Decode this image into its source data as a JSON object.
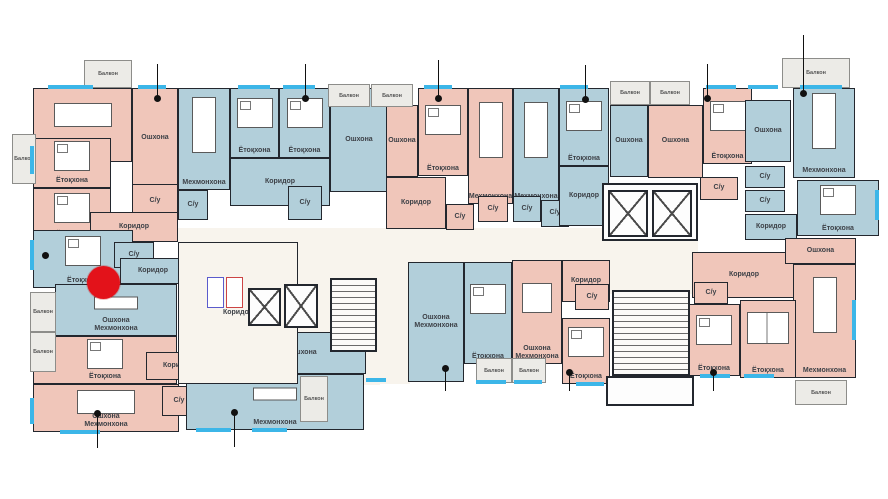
{
  "plan": {
    "canvas": {
      "w": 888,
      "h": 499
    },
    "colors": {
      "pink": "#f0c6ba",
      "blue": "#b2cfda",
      "wall": "#23272e",
      "cream": "#f8f4ed",
      "balcony": "#ecebe7",
      "window": "#3cb6e8",
      "red": "#e3121a",
      "dot": "#111111"
    },
    "backdrops": [
      {
        "x": 178,
        "y": 228,
        "w": 428,
        "h": 34
      },
      {
        "x": 378,
        "y": 258,
        "w": 32,
        "h": 126
      },
      {
        "x": 598,
        "y": 238,
        "w": 100,
        "h": 56
      },
      {
        "x": 296,
        "y": 256,
        "w": 84,
        "h": 128
      },
      {
        "x": 318,
        "y": 255,
        "w": 62,
        "h": 130
      }
    ]
  },
  "rooms": [
    {
      "name": "living-nw",
      "label": "Мехмонхона",
      "x": 33,
      "y": 88,
      "w": 99,
      "h": 74,
      "fill": "pink",
      "furniture": "table-h"
    },
    {
      "name": "kitchen-nw",
      "label": "Ошхона",
      "x": 132,
      "y": 88,
      "w": 46,
      "h": 100,
      "fill": "pink",
      "furniture": null
    },
    {
      "name": "bedroom-nw-1",
      "label": "Ётоқхона",
      "x": 33,
      "y": 138,
      "w": 78,
      "h": 50,
      "fill": "pink",
      "furniture": "bed"
    },
    {
      "name": "bedroom-nw-2",
      "label": "Ётоқхона",
      "x": 33,
      "y": 188,
      "w": 78,
      "h": 54,
      "fill": "pink",
      "furniture": "bed"
    },
    {
      "name": "bath-nw",
      "label": "С/у",
      "x": 132,
      "y": 184,
      "w": 46,
      "h": 34,
      "fill": "pink",
      "furniture": null
    },
    {
      "name": "corridor-nw",
      "label": "Коридор",
      "x": 90,
      "y": 212,
      "w": 88,
      "h": 30,
      "fill": "pink",
      "furniture": null
    },
    {
      "name": "living-a",
      "label": "Мехмонхона",
      "x": 178,
      "y": 88,
      "w": 52,
      "h": 102,
      "fill": "blue",
      "furniture": "table-v"
    },
    {
      "name": "bath-a1",
      "label": "С/у",
      "x": 178,
      "y": 190,
      "w": 30,
      "h": 30,
      "fill": "blue",
      "furniture": null
    },
    {
      "name": "bedroom-a1",
      "label": "Ётоқхона",
      "x": 230,
      "y": 88,
      "w": 49,
      "h": 70,
      "fill": "blue",
      "furniture": "bed"
    },
    {
      "name": "bedroom-a2",
      "label": "Ётоқхона",
      "x": 279,
      "y": 88,
      "w": 51,
      "h": 70,
      "fill": "blue",
      "furniture": "bed"
    },
    {
      "name": "corridor-a",
      "label": "Коридор",
      "x": 230,
      "y": 158,
      "w": 100,
      "h": 48,
      "fill": "blue",
      "furniture": null
    },
    {
      "name": "kitchen-a",
      "label": "Ошхона",
      "x": 330,
      "y": 88,
      "w": 58,
      "h": 104,
      "fill": "blue",
      "furniture": null
    },
    {
      "name": "bath-a2",
      "label": "С/у",
      "x": 288,
      "y": 186,
      "w": 34,
      "h": 34,
      "fill": "blue",
      "furniture": null
    },
    {
      "name": "kitchen-b",
      "label": "Ошхона",
      "x": 386,
      "y": 105,
      "w": 32,
      "h": 72,
      "fill": "pink",
      "furniture": null
    },
    {
      "name": "bedroom-b",
      "label": "Ётоқхона",
      "x": 418,
      "y": 88,
      "w": 50,
      "h": 88,
      "fill": "pink",
      "furniture": "bed"
    },
    {
      "name": "living-b",
      "label": "Мехмонхона",
      "x": 468,
      "y": 88,
      "w": 45,
      "h": 116,
      "fill": "pink",
      "furniture": "table-v"
    },
    {
      "name": "corridor-b",
      "label": "Коридор",
      "x": 386,
      "y": 177,
      "w": 60,
      "h": 52,
      "fill": "pink",
      "furniture": null
    },
    {
      "name": "bath-b1",
      "label": "С/у",
      "x": 446,
      "y": 204,
      "w": 28,
      "h": 26,
      "fill": "pink",
      "furniture": null
    },
    {
      "name": "bath-b2",
      "label": "С/у",
      "x": 478,
      "y": 196,
      "w": 30,
      "h": 26,
      "fill": "pink",
      "furniture": null
    },
    {
      "name": "living-c",
      "label": "Мехмонхона",
      "x": 513,
      "y": 88,
      "w": 46,
      "h": 116,
      "fill": "blue",
      "furniture": "table-v"
    },
    {
      "name": "bedroom-c",
      "label": "Ётоқхона",
      "x": 559,
      "y": 88,
      "w": 50,
      "h": 78,
      "fill": "blue",
      "furniture": "bed"
    },
    {
      "name": "bath-c1",
      "label": "С/у",
      "x": 513,
      "y": 196,
      "w": 28,
      "h": 26,
      "fill": "blue",
      "furniture": null
    },
    {
      "name": "bath-c2",
      "label": "С/у",
      "x": 541,
      "y": 200,
      "w": 28,
      "h": 27,
      "fill": "blue",
      "furniture": null
    },
    {
      "name": "corridor-c",
      "label": "Коридор",
      "x": 559,
      "y": 166,
      "w": 50,
      "h": 60,
      "fill": "blue",
      "furniture": null
    },
    {
      "name": "kitchen-d",
      "label": "Ошхона",
      "x": 610,
      "y": 105,
      "w": 38,
      "h": 72,
      "fill": "blue",
      "furniture": null
    },
    {
      "name": "kitchen-e",
      "label": "Ошхона",
      "x": 648,
      "y": 105,
      "w": 55,
      "h": 73,
      "fill": "pink",
      "furniture": null
    },
    {
      "name": "bedroom-e",
      "label": "Ётоқхона",
      "x": 703,
      "y": 88,
      "w": 49,
      "h": 76,
      "fill": "pink",
      "furniture": "bed"
    },
    {
      "name": "bath-e",
      "label": "С/у",
      "x": 700,
      "y": 177,
      "w": 38,
      "h": 23,
      "fill": "pink",
      "furniture": null
    },
    {
      "name": "kitchen-f",
      "label": "Ошхона",
      "x": 745,
      "y": 100,
      "w": 46,
      "h": 62,
      "fill": "blue",
      "furniture": null
    },
    {
      "name": "living-f",
      "label": "Мехмонхона",
      "x": 793,
      "y": 88,
      "w": 62,
      "h": 90,
      "fill": "blue",
      "furniture": "table-v"
    },
    {
      "name": "bath-f1",
      "label": "С/у",
      "x": 745,
      "y": 166,
      "w": 40,
      "h": 22,
      "fill": "blue",
      "furniture": null
    },
    {
      "name": "bath-f2",
      "label": "С/у",
      "x": 745,
      "y": 190,
      "w": 40,
      "h": 22,
      "fill": "blue",
      "furniture": null
    },
    {
      "name": "corridor-f",
      "label": "Коридор",
      "x": 745,
      "y": 214,
      "w": 52,
      "h": 26,
      "fill": "blue",
      "furniture": null
    },
    {
      "name": "bedroom-f",
      "label": "Ётоқхона",
      "x": 797,
      "y": 180,
      "w": 82,
      "h": 56,
      "fill": "blue",
      "furniture": "bed"
    },
    {
      "name": "bedroom-w1",
      "label": "Ётоқхона",
      "x": 33,
      "y": 230,
      "w": 100,
      "h": 58,
      "fill": "blue",
      "furniture": "bed"
    },
    {
      "name": "bath-w1",
      "label": "С/у",
      "x": 114,
      "y": 242,
      "w": 40,
      "h": 26,
      "fill": "blue",
      "furniture": null
    },
    {
      "name": "corridor-w1",
      "label": "Коридор",
      "x": 120,
      "y": 258,
      "w": 66,
      "h": 26,
      "fill": "blue",
      "furniture": null
    },
    {
      "name": "kitchen-living-w",
      "label": "Ошхона\nМехмонхона",
      "x": 55,
      "y": 284,
      "w": 122,
      "h": 52,
      "fill": "blue",
      "furniture": "sofa"
    },
    {
      "name": "bedroom-sw",
      "label": "Ётоқхона",
      "x": 33,
      "y": 336,
      "w": 144,
      "h": 48,
      "fill": "pink",
      "furniture": "bed"
    },
    {
      "name": "corridor-sw",
      "label": "Коридор",
      "x": 146,
      "y": 352,
      "w": 64,
      "h": 28,
      "fill": "pink",
      "furniture": null
    },
    {
      "name": "kitchen-living-sw",
      "label": "Ошхона\nМехмонхона",
      "x": 33,
      "y": 384,
      "w": 146,
      "h": 48,
      "fill": "pink",
      "furniture": "table-h"
    },
    {
      "name": "bath-sw",
      "label": "С/у",
      "x": 162,
      "y": 386,
      "w": 34,
      "h": 30,
      "fill": "pink",
      "furniture": null
    },
    {
      "name": "bath-sm",
      "label": "С/у",
      "x": 196,
      "y": 342,
      "w": 44,
      "h": 30,
      "fill": "blue",
      "furniture": null
    },
    {
      "name": "kitchen-sm",
      "label": "Ошхона",
      "x": 240,
      "y": 332,
      "w": 126,
      "h": 42,
      "fill": "blue",
      "furniture": null
    },
    {
      "name": "living-sm",
      "label": "Мехмонхона",
      "x": 186,
      "y": 374,
      "w": 178,
      "h": 56,
      "fill": "blue",
      "furniture": "sofa"
    },
    {
      "name": "kitchen-living-cm",
      "label": "Ошхона\nМехмонхона",
      "x": 408,
      "y": 262,
      "w": 56,
      "h": 120,
      "fill": "blue",
      "furniture": null
    },
    {
      "name": "bedroom-cm",
      "label": "Ётоқхона",
      "x": 464,
      "y": 262,
      "w": 48,
      "h": 102,
      "fill": "blue",
      "furniture": "bed"
    },
    {
      "name": "kitchen-living-cp",
      "label": "Ошхона\nМехмонхона",
      "x": 512,
      "y": 260,
      "w": 50,
      "h": 104,
      "fill": "pink",
      "furniture": "table-s"
    },
    {
      "name": "corridor-cp",
      "label": "Коридор",
      "x": 562,
      "y": 260,
      "w": 48,
      "h": 42,
      "fill": "pink",
      "furniture": null
    },
    {
      "name": "bath-cp",
      "label": "С/у",
      "x": 575,
      "y": 284,
      "w": 34,
      "h": 26,
      "fill": "pink",
      "furniture": null
    },
    {
      "name": "bedroom-cp",
      "label": "Ётоқхона",
      "x": 562,
      "y": 318,
      "w": 48,
      "h": 66,
      "fill": "pink",
      "furniture": "bed"
    },
    {
      "name": "corridor-se",
      "label": "Коридор",
      "x": 692,
      "y": 252,
      "w": 104,
      "h": 46,
      "fill": "pink",
      "furniture": null
    },
    {
      "name": "bath-se",
      "label": "С/у",
      "x": 694,
      "y": 282,
      "w": 34,
      "h": 22,
      "fill": "pink",
      "furniture": null
    },
    {
      "name": "kitchen-se",
      "label": "Ошхона",
      "x": 785,
      "y": 238,
      "w": 71,
      "h": 26,
      "fill": "pink",
      "furniture": null
    },
    {
      "name": "living-se",
      "label": "Мехмонхона",
      "x": 793,
      "y": 264,
      "w": 63,
      "h": 114,
      "fill": "pink",
      "furniture": "table-v"
    },
    {
      "name": "bedroom-se1",
      "label": "Ётоқхона",
      "x": 688,
      "y": 304,
      "w": 52,
      "h": 72,
      "fill": "pink",
      "furniture": "bed"
    },
    {
      "name": "bedroom-se2",
      "label": "Ётоқхона",
      "x": 740,
      "y": 300,
      "w": 56,
      "h": 78,
      "fill": "pink",
      "furniture": "bed2"
    },
    {
      "name": "lobby-corridor",
      "label": "Коридор",
      "x": 178,
      "y": 242,
      "w": 120,
      "h": 142,
      "fill": "white",
      "furniture": null
    }
  ],
  "balconies": [
    {
      "label": "Балкон",
      "x": 84,
      "y": 60,
      "w": 48,
      "h": 28
    },
    {
      "label": "Балкон",
      "x": 12,
      "y": 134,
      "w": 24,
      "h": 50
    },
    {
      "label": "Балкон",
      "x": 328,
      "y": 84,
      "w": 42,
      "h": 23
    },
    {
      "label": "Балкон",
      "x": 371,
      "y": 84,
      "w": 42,
      "h": 23
    },
    {
      "label": "Балкон",
      "x": 610,
      "y": 81,
      "w": 40,
      "h": 24
    },
    {
      "label": "Балкон",
      "x": 650,
      "y": 81,
      "w": 40,
      "h": 24
    },
    {
      "label": "Балкон",
      "x": 782,
      "y": 58,
      "w": 68,
      "h": 30
    },
    {
      "label": "Балкон",
      "x": 30,
      "y": 292,
      "w": 26,
      "h": 40
    },
    {
      "label": "Балкон",
      "x": 30,
      "y": 332,
      "w": 26,
      "h": 40
    },
    {
      "label": "Балкон",
      "x": 300,
      "y": 376,
      "w": 28,
      "h": 46
    },
    {
      "label": "Балкон",
      "x": 476,
      "y": 358,
      "w": 36,
      "h": 25
    },
    {
      "label": "Балкон",
      "x": 512,
      "y": 358,
      "w": 34,
      "h": 25
    },
    {
      "label": "Балкон",
      "x": 795,
      "y": 380,
      "w": 52,
      "h": 25
    }
  ],
  "features": [
    {
      "type": "core",
      "x": 602,
      "y": 183,
      "w": 96,
      "h": 58
    },
    {
      "type": "elevator",
      "x": 608,
      "y": 190,
      "w": 40,
      "h": 47
    },
    {
      "type": "elevator",
      "x": 652,
      "y": 190,
      "w": 40,
      "h": 47
    },
    {
      "type": "elevator",
      "x": 248,
      "y": 288,
      "w": 33,
      "h": 38
    },
    {
      "type": "elevator",
      "x": 284,
      "y": 284,
      "w": 34,
      "h": 44
    },
    {
      "type": "stairs",
      "x": 330,
      "y": 278,
      "w": 47,
      "h": 74
    },
    {
      "type": "stairs",
      "x": 612,
      "y": 290,
      "w": 78,
      "h": 86
    },
    {
      "type": "vestibule",
      "x": 606,
      "y": 376,
      "w": 88,
      "h": 30
    },
    {
      "type": "chute-blue",
      "x": 207,
      "y": 277,
      "w": 17,
      "h": 31
    },
    {
      "type": "chute-red",
      "x": 226,
      "y": 277,
      "w": 17,
      "h": 31
    }
  ],
  "windows": [
    {
      "x": 48,
      "y": 85,
      "w": 45,
      "h": 4
    },
    {
      "x": 138,
      "y": 85,
      "w": 28,
      "h": 4
    },
    {
      "x": 238,
      "y": 85,
      "w": 32,
      "h": 4
    },
    {
      "x": 283,
      "y": 85,
      "w": 32,
      "h": 4
    },
    {
      "x": 424,
      "y": 85,
      "w": 28,
      "h": 4
    },
    {
      "x": 560,
      "y": 85,
      "w": 28,
      "h": 4
    },
    {
      "x": 706,
      "y": 85,
      "w": 30,
      "h": 4
    },
    {
      "x": 748,
      "y": 85,
      "w": 30,
      "h": 4
    },
    {
      "x": 800,
      "y": 85,
      "w": 42,
      "h": 4
    },
    {
      "x": 30,
      "y": 146,
      "w": 4,
      "h": 28
    },
    {
      "x": 30,
      "y": 240,
      "w": 4,
      "h": 30
    },
    {
      "x": 30,
      "y": 398,
      "w": 4,
      "h": 26
    },
    {
      "x": 60,
      "y": 430,
      "w": 40,
      "h": 4
    },
    {
      "x": 196,
      "y": 428,
      "w": 35,
      "h": 4
    },
    {
      "x": 252,
      "y": 428,
      "w": 35,
      "h": 4
    },
    {
      "x": 366,
      "y": 378,
      "w": 20,
      "h": 4
    },
    {
      "x": 476,
      "y": 380,
      "w": 30,
      "h": 4
    },
    {
      "x": 514,
      "y": 380,
      "w": 28,
      "h": 4
    },
    {
      "x": 576,
      "y": 382,
      "w": 28,
      "h": 4
    },
    {
      "x": 700,
      "y": 374,
      "w": 30,
      "h": 4
    },
    {
      "x": 744,
      "y": 374,
      "w": 30,
      "h": 4
    },
    {
      "x": 852,
      "y": 300,
      "w": 4,
      "h": 40
    },
    {
      "x": 875,
      "y": 190,
      "w": 4,
      "h": 30
    }
  ],
  "dots": [
    {
      "x": 157,
      "y": 98,
      "stem": "up",
      "len": 34
    },
    {
      "x": 305,
      "y": 98,
      "stem": "up",
      "len": 34
    },
    {
      "x": 438,
      "y": 98,
      "stem": "up",
      "len": 38
    },
    {
      "x": 585,
      "y": 99,
      "stem": "up",
      "len": 34
    },
    {
      "x": 707,
      "y": 98,
      "stem": "up",
      "len": 34
    },
    {
      "x": 803,
      "y": 93,
      "stem": "up",
      "len": 58
    },
    {
      "x": 45,
      "y": 255,
      "stem": "none",
      "len": 0
    },
    {
      "x": 97,
      "y": 413,
      "stem": "down",
      "len": 32
    },
    {
      "x": 234,
      "y": 412,
      "stem": "down",
      "len": 32
    },
    {
      "x": 445,
      "y": 368,
      "stem": "down",
      "len": 20
    },
    {
      "x": 569,
      "y": 372,
      "stem": "down",
      "len": 16
    },
    {
      "x": 713,
      "y": 372,
      "stem": "down",
      "len": 16
    }
  ],
  "marker": {
    "kind": "red-circle",
    "x": 87,
    "y": 266,
    "d": 33
  }
}
